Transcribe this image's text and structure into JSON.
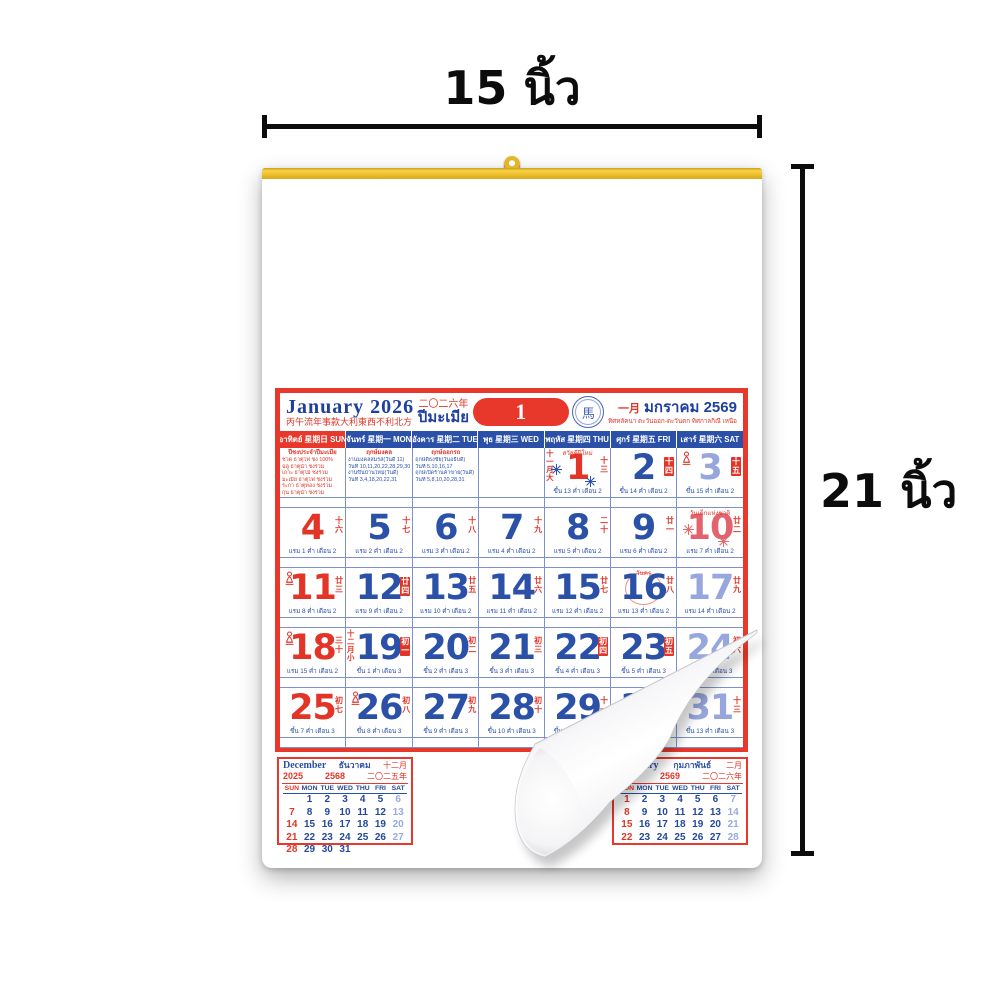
{
  "annotations": {
    "width": {
      "label": "15 นิ้ว"
    },
    "height": {
      "label": "21 นิ้ว"
    }
  },
  "colors": {
    "red": "#e23527",
    "blue": "#2b50a8",
    "saturday_blue": "#97a7dd",
    "holiday_pink": "#e2636e",
    "frame_red": "#e8382b",
    "gold_strip": "#efbe2c",
    "annotation_black": "#0c0c0c",
    "title_navy": "#1f3f9e"
  },
  "calendar": {
    "header": {
      "title": "January 2026",
      "fortune_cn": "丙午流年事款大利東西不利北方",
      "year_cn": "二〇二六年",
      "zodiac_th": "ปีมะเมีย",
      "day_number": "1",
      "stamp_cn": "馬",
      "month_cn": "一月",
      "month_th": "มกราคม 2569",
      "directions_th": "ทิศหลัคนา ตะวันออก-ตะวันตก ทิศกาลกิณี เหนือ"
    },
    "day_headers": [
      {
        "th": "อาทิตย์",
        "cn": "星期日",
        "en": "SUN",
        "type": "sun"
      },
      {
        "th": "จันทร์",
        "cn": "星期一",
        "en": "MON",
        "type": "wk"
      },
      {
        "th": "อังคาร",
        "cn": "星期二",
        "en": "TUE",
        "type": "wk"
      },
      {
        "th": "พุธ",
        "cn": "星期三",
        "en": "WED",
        "type": "wk"
      },
      {
        "th": "พฤหัส",
        "cn": "星期四",
        "en": "THU",
        "type": "wk"
      },
      {
        "th": "ศุกร์",
        "cn": "星期五",
        "en": "FRI",
        "type": "wk"
      },
      {
        "th": "เสาร์",
        "cn": "星期六",
        "en": "SAT",
        "type": "wk"
      }
    ],
    "notes": {
      "sun": {
        "style": "red",
        "title": "ปีชงประจำปีมะเมีย",
        "lines": [
          "ชวด ธาตุไฟ ชง 100%",
          "ฉลู ธาตุน้ำ ชงร่วม",
          "เถาะ ธาตุไม้ ชงร่วม",
          "มะเมีย ธาตุไฟ ชงร่วม",
          "ระกา ธาตุทอง ชงร่วม",
          "กุน ธาตุน้ำ ชงร่วม"
        ]
      },
      "mon": {
        "style": "blue",
        "title": "ฤกษ์มงคล",
        "lines": [
          "งานมงคลสมรส(วันดี 11)",
          "วันที่ 10,11,20,22,28,29,30",
          "งานขึ้นบ้านใหม่(วันดี)",
          "วันที่ 3,4,18,20,22,31"
        ]
      },
      "tue": {
        "style": "blue",
        "title": "ฤกษ์ออกรถ",
        "lines": [
          "ฤกษ์ดีธงชัย(วันอธิบดี)",
          "วันที่ 5,10,16,17",
          "ฤกษ์เปิดร้านค้าขาย(วันดี)",
          "วันที่ 5,8,10,20,28,31"
        ]
      }
    },
    "days": [
      {
        "n": 1,
        "c": "r",
        "badge": "十三",
        "boxed": false,
        "side": "十一月大",
        "icon": null,
        "label": "สวัสดีปีใหม่",
        "decor": "fireworks-blue",
        "lunar": "ขึ้น 13 ค่ำ เดือน 2"
      },
      {
        "n": 2,
        "c": "b",
        "badge": "十四",
        "boxed": true,
        "side": null,
        "icon": null,
        "label": null,
        "decor": null,
        "lunar": "ขึ้น 14 ค่ำ เดือน 2"
      },
      {
        "n": 3,
        "c": "s",
        "badge": "十五",
        "boxed": true,
        "side": null,
        "icon": "buddha",
        "label": null,
        "decor": null,
        "lunar": "ขึ้น 15 ค่ำ เดือน 2"
      },
      {
        "n": 4,
        "c": "r",
        "badge": "十六",
        "boxed": false,
        "side": null,
        "icon": null,
        "label": null,
        "decor": null,
        "lunar": "แรม 1 ค่ำ เดือน 2"
      },
      {
        "n": 5,
        "c": "b",
        "badge": "十七",
        "boxed": false,
        "side": null,
        "icon": null,
        "label": null,
        "decor": null,
        "lunar": "แรม 2 ค่ำ เดือน 2"
      },
      {
        "n": 6,
        "c": "b",
        "badge": "十八",
        "boxed": false,
        "side": null,
        "icon": null,
        "label": null,
        "decor": null,
        "lunar": "แรม 3 ค่ำ เดือน 2"
      },
      {
        "n": 7,
        "c": "b",
        "badge": "十九",
        "boxed": false,
        "side": null,
        "icon": null,
        "label": null,
        "decor": null,
        "lunar": "แรม 4 ค่ำ เดือน 2"
      },
      {
        "n": 8,
        "c": "b",
        "badge": "二十",
        "boxed": false,
        "side": null,
        "icon": null,
        "label": null,
        "decor": null,
        "lunar": "แรม 5 ค่ำ เดือน 2"
      },
      {
        "n": 9,
        "c": "b",
        "badge": "廿一",
        "boxed": false,
        "side": null,
        "icon": null,
        "label": null,
        "decor": null,
        "lunar": "แรม 6 ค่ำ เดือน 2"
      },
      {
        "n": 10,
        "c": "h",
        "badge": "廿二",
        "boxed": false,
        "side": null,
        "icon": null,
        "label": "วันเด็กแห่งชาติ",
        "decor": "fireworks-red",
        "lunar": "แรม 7 ค่ำ เดือน 2"
      },
      {
        "n": 11,
        "c": "r",
        "badge": "廿三",
        "boxed": false,
        "side": null,
        "icon": "buddha",
        "label": null,
        "decor": null,
        "lunar": "แรม 8 ค่ำ เดือน 2"
      },
      {
        "n": 12,
        "c": "b",
        "badge": "廿四",
        "boxed": true,
        "side": null,
        "icon": null,
        "label": null,
        "decor": null,
        "lunar": "แรม 9 ค่ำ เดือน 2"
      },
      {
        "n": 13,
        "c": "b",
        "badge": "廿五",
        "boxed": false,
        "side": null,
        "icon": null,
        "label": null,
        "decor": null,
        "lunar": "แรม 10 ค่ำ เดือน 2"
      },
      {
        "n": 14,
        "c": "b",
        "badge": "廿六",
        "boxed": false,
        "side": null,
        "icon": null,
        "label": null,
        "decor": null,
        "lunar": "แรม 11 ค่ำ เดือน 2"
      },
      {
        "n": 15,
        "c": "b",
        "badge": "廿七",
        "boxed": false,
        "side": null,
        "icon": null,
        "label": null,
        "decor": null,
        "lunar": "แรม 12 ค่ำ เดือน 2"
      },
      {
        "n": 16,
        "c": "b",
        "badge": "廿八",
        "boxed": false,
        "side": null,
        "icon": null,
        "label": "วันครู",
        "decor": "scribble-red",
        "lunar": "แรม 13 ค่ำ เดือน 2"
      },
      {
        "n": 17,
        "c": "s",
        "badge": "廿九",
        "boxed": false,
        "side": null,
        "icon": null,
        "label": null,
        "decor": null,
        "lunar": "แรม 14 ค่ำ เดือน 2"
      },
      {
        "n": 18,
        "c": "r",
        "badge": "三十",
        "boxed": false,
        "side": null,
        "icon": "buddha",
        "label": null,
        "decor": null,
        "lunar": "แรม 15 ค่ำ เดือน 2"
      },
      {
        "n": 19,
        "c": "b",
        "badge": "初一",
        "boxed": true,
        "side": "十二月小",
        "icon": null,
        "label": null,
        "decor": null,
        "lunar": "ขึ้น 1 ค่ำ เดือน 3"
      },
      {
        "n": 20,
        "c": "b",
        "badge": "初二",
        "boxed": false,
        "side": null,
        "icon": null,
        "label": null,
        "decor": null,
        "lunar": "ขึ้น 2 ค่ำ เดือน 3"
      },
      {
        "n": 21,
        "c": "b",
        "badge": "初三",
        "boxed": false,
        "side": null,
        "icon": null,
        "label": null,
        "decor": null,
        "lunar": "ขึ้น 3 ค่ำ เดือน 3"
      },
      {
        "n": 22,
        "c": "b",
        "badge": "初四",
        "boxed": true,
        "side": null,
        "icon": null,
        "label": null,
        "decor": null,
        "lunar": "ขึ้น 4 ค่ำ เดือน 3"
      },
      {
        "n": 23,
        "c": "b",
        "badge": "初五",
        "boxed": true,
        "side": null,
        "icon": null,
        "label": null,
        "decor": null,
        "lunar": "ขึ้น 5 ค่ำ เดือน 3"
      },
      {
        "n": 24,
        "c": "s",
        "badge": "初六",
        "boxed": false,
        "side": null,
        "icon": null,
        "label": null,
        "decor": null,
        "lunar": "ขึ้น 6 ค่ำ เดือน 3"
      },
      {
        "n": 25,
        "c": "r",
        "badge": "初七",
        "boxed": false,
        "side": null,
        "icon": null,
        "label": null,
        "decor": null,
        "lunar": "ขึ้น 7 ค่ำ เดือน 3"
      },
      {
        "n": 26,
        "c": "b",
        "badge": "初八",
        "boxed": false,
        "side": null,
        "icon": "buddha",
        "label": null,
        "decor": null,
        "lunar": "ขึ้น 8 ค่ำ เดือน 3"
      },
      {
        "n": 27,
        "c": "b",
        "badge": "初九",
        "boxed": false,
        "side": null,
        "icon": null,
        "label": null,
        "decor": null,
        "lunar": "ขึ้น 9 ค่ำ เดือน 3"
      },
      {
        "n": 28,
        "c": "b",
        "badge": "初十",
        "boxed": false,
        "side": null,
        "icon": null,
        "label": null,
        "decor": null,
        "lunar": "ขึ้น 10 ค่ำ เดือน 3"
      },
      {
        "n": 29,
        "c": "b",
        "badge": "十一",
        "boxed": false,
        "side": null,
        "icon": null,
        "label": null,
        "decor": null,
        "lunar": "ขึ้น 11 ค่ำ เดือน 3"
      },
      {
        "n": 30,
        "c": "b",
        "badge": "十二",
        "boxed": false,
        "side": null,
        "icon": null,
        "label": null,
        "decor": null,
        "lunar": "ขึ้น 12 ค่ำ เดือน 3"
      },
      {
        "n": 31,
        "c": "s",
        "badge": "十三",
        "boxed": false,
        "side": null,
        "icon": null,
        "label": null,
        "decor": null,
        "lunar": "ขึ้น 13 ค่ำ เดือน 3"
      }
    ]
  },
  "mini_calendars": [
    {
      "id": "december",
      "title_en": "December",
      "title_th": "ธันวาคม",
      "month_cn": "十二月",
      "year": "2025",
      "year_th": "2568",
      "year_cn": "二〇二五年",
      "day_headers": [
        "SUN",
        "MON",
        "TUE",
        "WED",
        "THU",
        "FRI",
        "SAT"
      ],
      "rows": [
        [
          "",
          "1",
          "2",
          "3",
          "4",
          "5",
          "6"
        ],
        [
          "7",
          "8",
          "9",
          "10",
          "11",
          "12",
          "13"
        ],
        [
          "14",
          "15",
          "16",
          "17",
          "18",
          "19",
          "20"
        ],
        [
          "21",
          "22",
          "23",
          "24",
          "25",
          "26",
          "27"
        ],
        [
          "28",
          "29",
          "30",
          "31",
          "",
          "",
          ""
        ]
      ]
    },
    {
      "id": "february",
      "title_en": "February",
      "title_th": "กุมภาพันธ์",
      "month_cn": "二月",
      "year": "2026",
      "year_th": "2569",
      "year_cn": "二〇二六年",
      "day_headers": [
        "SUN",
        "MON",
        "TUE",
        "WED",
        "THU",
        "FRI",
        "SAT"
      ],
      "rows": [
        [
          "1",
          "2",
          "3",
          "4",
          "5",
          "6",
          "7"
        ],
        [
          "8",
          "9",
          "10",
          "11",
          "12",
          "13",
          "14"
        ],
        [
          "15",
          "16",
          "17",
          "18",
          "19",
          "20",
          "21"
        ],
        [
          "22",
          "23",
          "24",
          "25",
          "26",
          "27",
          "28"
        ]
      ]
    }
  ]
}
